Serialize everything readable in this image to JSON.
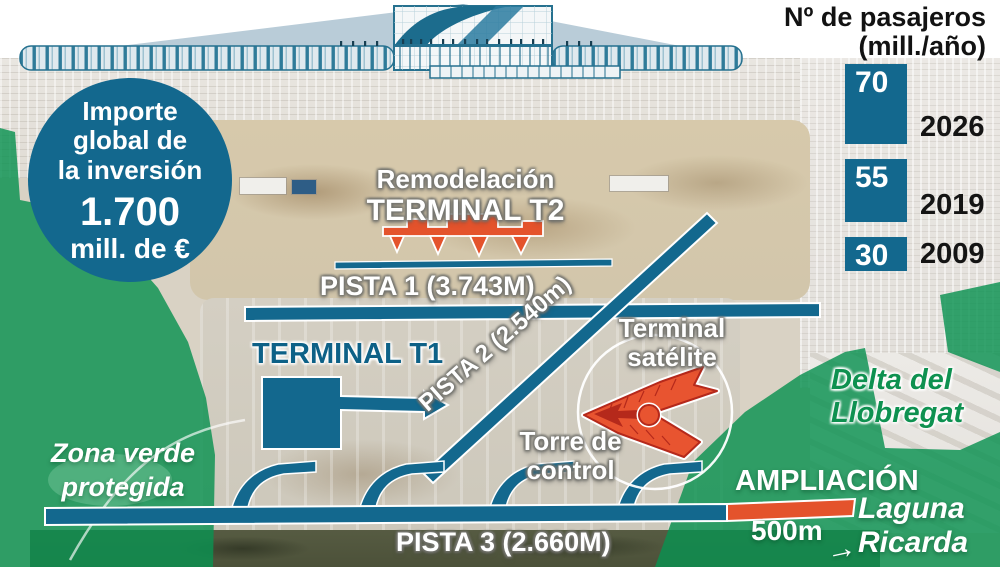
{
  "colors": {
    "teal": "#13688e",
    "orange": "#e4532c",
    "red_outline": "#b5291b",
    "green_overlay": "#0a9150",
    "green_text": "#0e9150"
  },
  "badge": {
    "line1": "Importe",
    "line2": "global de",
    "line3": "la inversión",
    "amount": "1.700",
    "unit": "mill. de €"
  },
  "chart_data": {
    "type": "bar",
    "title": "Nº de pasajeros",
    "subtitle": "(mill./año)",
    "categories": [
      "2026",
      "2019",
      "2009"
    ],
    "values": [
      70,
      55,
      30
    ],
    "bar_color": "#13688e",
    "orientation": "vertical",
    "value_label_position": "inside-top-left",
    "category_label_position": "right-of-bar",
    "ylim": [
      0,
      70
    ],
    "gridlines": false,
    "legend": false
  },
  "map": {
    "remodel": {
      "line1": "Remodelación",
      "line2": "TERMINAL T2"
    },
    "runway1": "PISTA 1 (3.743M)",
    "runway2": "PISTA 2 (2.540m)",
    "runway3": "PISTA 3 (2.660M)",
    "terminal_t1": "TERMINAL T1",
    "terminal_satellite": {
      "line1": "Terminal",
      "line2": "satélite"
    },
    "control_tower": {
      "line1": "Torre de",
      "line2": "control"
    },
    "expansion": "AMPLIACIÓN",
    "scale_label": "500m",
    "green_zone": {
      "line1": "Zona verde",
      "line2": "protegida"
    },
    "delta": {
      "line1": "Delta del",
      "line2": "Llobregat"
    },
    "laguna": {
      "line1": "Laguna",
      "line2": "Ricarda"
    },
    "laguna_arrow": "→"
  }
}
